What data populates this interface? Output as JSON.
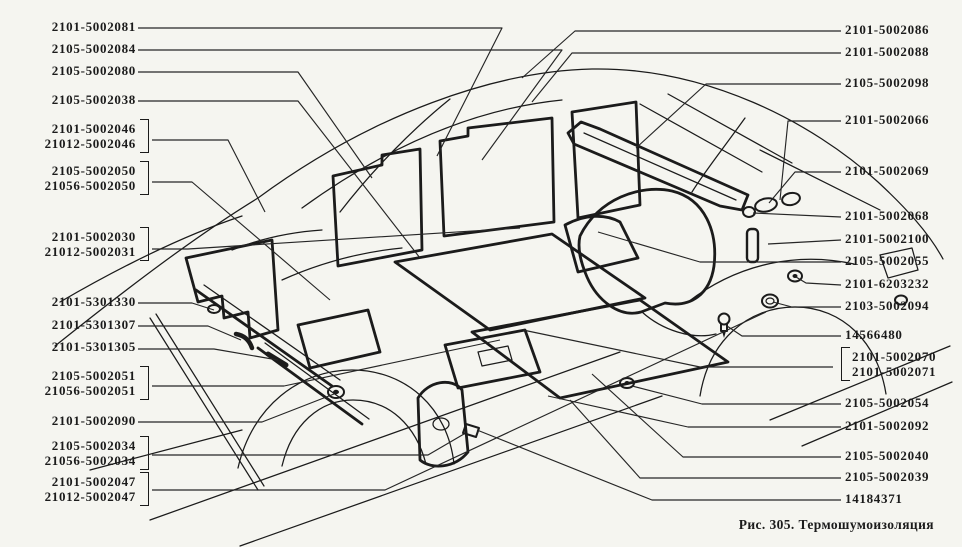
{
  "colors": {
    "background": "#f5f5f0",
    "ink": "#1b1b1b"
  },
  "figure": {
    "caption": "Рис. 305. Термошумоизоляция",
    "number": "305",
    "title": "Термошумоизоляция"
  },
  "labels": {
    "left": [
      {
        "lines": [
          "2101-5002081"
        ],
        "top": 20,
        "bracket": false
      },
      {
        "lines": [
          "2105-5002084"
        ],
        "top": 42,
        "bracket": false
      },
      {
        "lines": [
          "2105-5002080"
        ],
        "top": 64,
        "bracket": false
      },
      {
        "lines": [
          "2105-5002038"
        ],
        "top": 93,
        "bracket": false
      },
      {
        "lines": [
          "2101-5002046",
          "21012-5002046"
        ],
        "top": 122,
        "bracket": true
      },
      {
        "lines": [
          "2105-5002050",
          "21056-5002050"
        ],
        "top": 164,
        "bracket": true
      },
      {
        "lines": [
          "2101-5002030",
          "21012-5002031"
        ],
        "top": 230,
        "bracket": true
      },
      {
        "lines": [
          "2101-5301330"
        ],
        "top": 295,
        "bracket": false
      },
      {
        "lines": [
          "2101-5301307"
        ],
        "top": 318,
        "bracket": false
      },
      {
        "lines": [
          "2101-5301305"
        ],
        "top": 340,
        "bracket": false
      },
      {
        "lines": [
          "2105-5002051",
          "21056-5002051"
        ],
        "top": 369,
        "bracket": true
      },
      {
        "lines": [
          "2101-5002090"
        ],
        "top": 414,
        "bracket": false
      },
      {
        "lines": [
          "2105-5002034",
          "21056-5002034"
        ],
        "top": 439,
        "bracket": true
      },
      {
        "lines": [
          "2101-5002047",
          "21012-5002047"
        ],
        "top": 475,
        "bracket": true
      }
    ],
    "right": [
      {
        "lines": [
          "2101-5002086"
        ],
        "top": 23,
        "bracket": false
      },
      {
        "lines": [
          "2101-5002088"
        ],
        "top": 45,
        "bracket": false
      },
      {
        "lines": [
          "2105-5002098"
        ],
        "top": 76,
        "bracket": false
      },
      {
        "lines": [
          "2101-5002066"
        ],
        "top": 113,
        "bracket": false
      },
      {
        "lines": [
          "2101-5002069"
        ],
        "top": 164,
        "bracket": false
      },
      {
        "lines": [
          "2101-5002068"
        ],
        "top": 209,
        "bracket": false
      },
      {
        "lines": [
          "2101-5002100"
        ],
        "top": 232,
        "bracket": false
      },
      {
        "lines": [
          "2105-5002055"
        ],
        "top": 254,
        "bracket": false
      },
      {
        "lines": [
          "2101-6203232"
        ],
        "top": 277,
        "bracket": false
      },
      {
        "lines": [
          "2103-5002094"
        ],
        "top": 299,
        "bracket": false
      },
      {
        "lines": [
          "14566480"
        ],
        "top": 328,
        "bracket": false
      },
      {
        "lines": [
          "2101-5002070",
          "2101-5002071"
        ],
        "top": 350,
        "bracket": true
      },
      {
        "lines": [
          "2105-5002054"
        ],
        "top": 396,
        "bracket": false
      },
      {
        "lines": [
          "2101-5002092"
        ],
        "top": 419,
        "bracket": false
      },
      {
        "lines": [
          "2105-5002040"
        ],
        "top": 449,
        "bracket": false
      },
      {
        "lines": [
          "2105-5002039"
        ],
        "top": 470,
        "bracket": false
      },
      {
        "lines": [
          "14184371"
        ],
        "top": 492,
        "bracket": false
      }
    ]
  }
}
